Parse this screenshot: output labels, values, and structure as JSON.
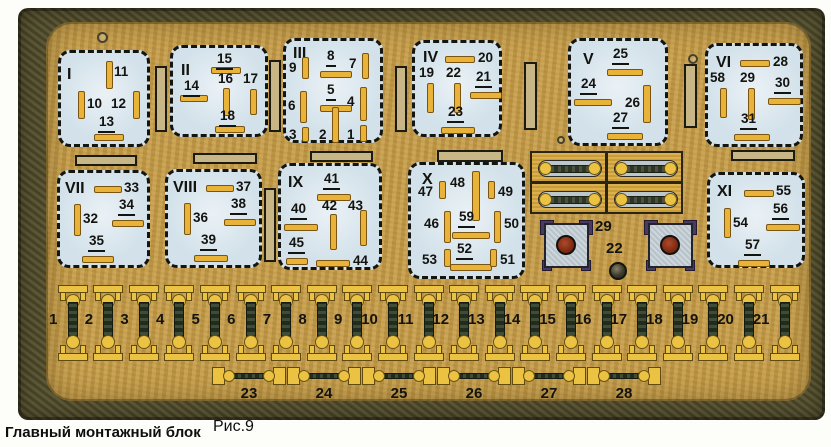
{
  "caption": {
    "title": "Главный монтажный блок",
    "figure": "Рис.9"
  },
  "colors": {
    "panel": "#c59c49",
    "frame": "#534e2c",
    "relay": "#d2e1ea",
    "pin": "#e9b238",
    "pin-border": "#7a5512",
    "slot": "#c8b687",
    "fuse": "#ecc243",
    "conn-body": "#c6d1d8",
    "conn-ear": "#4b3a60",
    "conn-circle": "#7e2b12",
    "ink": "#13130f"
  },
  "relays": [
    {
      "id": "I",
      "x": 58,
      "y": 50,
      "w": 92,
      "h": 97,
      "lx": 6,
      "ly": 14,
      "pins": [
        {
          "n": "11",
          "u": false,
          "px": 45,
          "py": 8,
          "pw": 7,
          "ph": 28,
          "lx": 53,
          "ly": 12
        },
        {
          "n": "10",
          "u": false,
          "px": 17,
          "py": 38,
          "pw": 7,
          "ph": 28,
          "lx": 26,
          "ly": 44
        },
        {
          "n": "12",
          "u": false,
          "px": 72,
          "py": 38,
          "pw": 7,
          "ph": 28,
          "lx": 50,
          "ly": 44
        },
        {
          "n": "13",
          "u": true,
          "px": 33,
          "py": 81,
          "pw": 30,
          "ph": 7,
          "lx": 37,
          "ly": 62
        }
      ]
    },
    {
      "id": "II",
      "x": 170,
      "y": 45,
      "w": 98,
      "h": 92,
      "lx": 8,
      "ly": 15,
      "pins": [
        {
          "n": "15",
          "u": true,
          "px": 38,
          "py": 19,
          "pw": 30,
          "ph": 7,
          "lx": 43,
          "ly": 4
        },
        {
          "n": "14",
          "u": true,
          "px": 7,
          "py": 47,
          "pw": 28,
          "ph": 7,
          "lx": 10,
          "ly": 31
        },
        {
          "n": "16",
          "u": false,
          "px": 50,
          "py": 40,
          "pw": 7,
          "ph": 28,
          "lx": 45,
          "ly": 24
        },
        {
          "n": "17",
          "u": false,
          "px": 77,
          "py": 41,
          "pw": 7,
          "ph": 26,
          "lx": 70,
          "ly": 24
        },
        {
          "n": "18",
          "u": true,
          "px": 42,
          "py": 78,
          "pw": 30,
          "ph": 7,
          "lx": 46,
          "ly": 61
        }
      ]
    },
    {
      "id": "III",
      "x": 283,
      "y": 38,
      "w": 100,
      "h": 105,
      "lx": 7,
      "ly": 5,
      "pins": [
        {
          "n": "9",
          "u": false,
          "px": 16,
          "py": 16,
          "pw": 7,
          "ph": 22,
          "lx": 3,
          "ly": 20
        },
        {
          "n": "8",
          "u": true,
          "px": 34,
          "py": 30,
          "pw": 32,
          "ph": 7,
          "lx": 40,
          "ly": 8
        },
        {
          "n": "7",
          "u": false,
          "px": 76,
          "py": 12,
          "pw": 7,
          "ph": 26,
          "lx": 63,
          "ly": 16
        },
        {
          "n": "6",
          "u": false,
          "px": 14,
          "py": 50,
          "pw": 7,
          "ph": 32,
          "lx": 2,
          "ly": 58
        },
        {
          "n": "5",
          "u": true,
          "px": 34,
          "py": 64,
          "pw": 32,
          "ph": 7,
          "lx": 40,
          "ly": 42
        },
        {
          "n": "4",
          "u": false,
          "px": 74,
          "py": 46,
          "pw": 7,
          "ph": 34,
          "lx": 61,
          "ly": 54
        },
        {
          "n": "3",
          "u": false,
          "px": 16,
          "py": 86,
          "pw": 7,
          "ph": 15,
          "lx": 3,
          "ly": 87
        },
        {
          "n": "2",
          "u": false,
          "px": 46,
          "py": 66,
          "pw": 7,
          "ph": 36,
          "lx": 33,
          "ly": 87
        },
        {
          "n": "1",
          "u": false,
          "px": 74,
          "py": 84,
          "pw": 7,
          "ph": 17,
          "lx": 61,
          "ly": 87
        }
      ]
    },
    {
      "id": "IV",
      "x": 412,
      "y": 40,
      "w": 90,
      "h": 97,
      "lx": 8,
      "ly": 7,
      "pins": [
        {
          "n": "20",
          "u": false,
          "px": 30,
          "py": 13,
          "pw": 30,
          "ph": 7,
          "lx": 63,
          "ly": 8
        },
        {
          "n": "19",
          "u": false,
          "px": 12,
          "py": 40,
          "pw": 7,
          "ph": 30,
          "lx": 4,
          "ly": 23
        },
        {
          "n": "22",
          "u": false,
          "px": 39,
          "py": 40,
          "pw": 7,
          "ph": 30,
          "lx": 31,
          "ly": 23
        },
        {
          "n": "21",
          "u": true,
          "px": 55,
          "py": 49,
          "pw": 32,
          "ph": 7,
          "lx": 60,
          "ly": 27
        },
        {
          "n": "23",
          "u": true,
          "px": 26,
          "py": 84,
          "pw": 34,
          "ph": 7,
          "lx": 32,
          "ly": 62
        }
      ]
    },
    {
      "id": "V",
      "x": 568,
      "y": 38,
      "w": 100,
      "h": 108,
      "lx": 12,
      "ly": 11,
      "pins": [
        {
          "n": "25",
          "u": true,
          "px": 36,
          "py": 28,
          "pw": 36,
          "ph": 7,
          "lx": 41,
          "ly": 6
        },
        {
          "n": "24",
          "u": true,
          "px": 3,
          "py": 58,
          "pw": 38,
          "ph": 7,
          "lx": 9,
          "ly": 36
        },
        {
          "n": "26",
          "u": false,
          "px": 72,
          "py": 44,
          "pw": 8,
          "ph": 38,
          "lx": 54,
          "ly": 55
        },
        {
          "n": "27",
          "u": true,
          "px": 36,
          "py": 92,
          "pw": 36,
          "ph": 7,
          "lx": 41,
          "ly": 70
        }
      ]
    },
    {
      "id": "VI",
      "x": 705,
      "y": 43,
      "w": 98,
      "h": 104,
      "lx": 8,
      "ly": 9,
      "pins": [
        {
          "n": "28",
          "u": false,
          "px": 32,
          "py": 14,
          "pw": 30,
          "ph": 7,
          "lx": 65,
          "ly": 9
        },
        {
          "n": "58",
          "u": false,
          "px": 12,
          "py": 42,
          "pw": 7,
          "ph": 30,
          "lx": 2,
          "ly": 25
        },
        {
          "n": "29",
          "u": false,
          "px": 40,
          "py": 42,
          "pw": 7,
          "ph": 32,
          "lx": 32,
          "ly": 25
        },
        {
          "n": "30",
          "u": true,
          "px": 60,
          "py": 52,
          "pw": 33,
          "ph": 7,
          "lx": 66,
          "ly": 30
        },
        {
          "n": "31",
          "u": true,
          "px": 26,
          "py": 88,
          "pw": 36,
          "ph": 7,
          "lx": 32,
          "ly": 66
        }
      ]
    },
    {
      "id": "VII",
      "x": 57,
      "y": 170,
      "w": 93,
      "h": 98,
      "lx": 5,
      "ly": 8,
      "pins": [
        {
          "n": "33",
          "u": false,
          "px": 34,
          "py": 13,
          "pw": 28,
          "ph": 7,
          "lx": 64,
          "ly": 8
        },
        {
          "n": "32",
          "u": false,
          "px": 14,
          "py": 31,
          "pw": 7,
          "ph": 32,
          "lx": 23,
          "ly": 39
        },
        {
          "n": "34",
          "u": true,
          "px": 52,
          "py": 47,
          "pw": 32,
          "ph": 7,
          "lx": 58,
          "ly": 25
        },
        {
          "n": "35",
          "u": true,
          "px": 22,
          "py": 83,
          "pw": 32,
          "ph": 7,
          "lx": 28,
          "ly": 61
        }
      ]
    },
    {
      "id": "VIII",
      "x": 165,
      "y": 169,
      "w": 97,
      "h": 99,
      "lx": 5,
      "ly": 8,
      "pins": [
        {
          "n": "37",
          "u": false,
          "px": 38,
          "py": 13,
          "pw": 28,
          "ph": 7,
          "lx": 68,
          "ly": 8
        },
        {
          "n": "36",
          "u": false,
          "px": 16,
          "py": 31,
          "pw": 7,
          "ph": 32,
          "lx": 25,
          "ly": 39
        },
        {
          "n": "38",
          "u": true,
          "px": 56,
          "py": 47,
          "pw": 32,
          "ph": 7,
          "lx": 62,
          "ly": 25
        },
        {
          "n": "39",
          "u": true,
          "px": 26,
          "py": 83,
          "pw": 34,
          "ph": 7,
          "lx": 32,
          "ly": 61
        }
      ]
    },
    {
      "id": "IX",
      "x": 278,
      "y": 163,
      "w": 104,
      "h": 107,
      "lx": 7,
      "ly": 9,
      "pins": [
        {
          "n": "41",
          "u": true,
          "px": 36,
          "py": 28,
          "pw": 34,
          "ph": 7,
          "lx": 42,
          "ly": 6
        },
        {
          "n": "40",
          "u": true,
          "px": 3,
          "py": 58,
          "pw": 34,
          "ph": 7,
          "lx": 9,
          "ly": 36
        },
        {
          "n": "42",
          "u": false,
          "px": 49,
          "py": 48,
          "pw": 7,
          "ph": 36,
          "lx": 41,
          "ly": 33
        },
        {
          "n": "43",
          "u": false,
          "px": 79,
          "py": 44,
          "pw": 7,
          "ph": 36,
          "lx": 67,
          "ly": 33
        },
        {
          "n": "45",
          "u": true,
          "px": 5,
          "py": 92,
          "pw": 22,
          "ph": 7,
          "lx": 7,
          "ly": 70
        },
        {
          "n": "44",
          "u": false,
          "px": 35,
          "py": 94,
          "pw": 34,
          "ph": 7,
          "lx": 72,
          "ly": 88
        }
      ]
    },
    {
      "id": "X",
      "x": 408,
      "y": 162,
      "w": 117,
      "h": 117,
      "lx": 11,
      "ly": 7,
      "pins": [
        {
          "n": "47",
          "u": false,
          "px": 28,
          "py": 16,
          "pw": 7,
          "ph": 18,
          "lx": 7,
          "ly": 20
        },
        {
          "n": "48",
          "u": false,
          "px": 61,
          "py": 6,
          "pw": 8,
          "ph": 50,
          "lx": 39,
          "ly": 11
        },
        {
          "n": "49",
          "u": false,
          "px": 77,
          "py": 16,
          "pw": 7,
          "ph": 18,
          "lx": 87,
          "ly": 20
        },
        {
          "n": "46",
          "u": false,
          "px": 33,
          "py": 46,
          "pw": 7,
          "ph": 32,
          "lx": 13,
          "ly": 52
        },
        {
          "n": "59",
          "u": true,
          "px": 41,
          "py": 67,
          "pw": 38,
          "ph": 7,
          "lx": 47,
          "ly": 45
        },
        {
          "n": "50",
          "u": false,
          "px": 83,
          "py": 46,
          "pw": 7,
          "ph": 32,
          "lx": 93,
          "ly": 52
        },
        {
          "n": "53",
          "u": false,
          "px": 33,
          "py": 84,
          "pw": 7,
          "ph": 18,
          "lx": 11,
          "ly": 88
        },
        {
          "n": "52",
          "u": true,
          "px": 39,
          "py": 99,
          "pw": 42,
          "ph": 7,
          "lx": 45,
          "ly": 77
        },
        {
          "n": "51",
          "u": false,
          "px": 79,
          "py": 84,
          "pw": 7,
          "ph": 18,
          "lx": 89,
          "ly": 88
        }
      ]
    },
    {
      "id": "XI",
      "x": 707,
      "y": 172,
      "w": 98,
      "h": 96,
      "lx": 7,
      "ly": 9,
      "pins": [
        {
          "n": "55",
          "u": false,
          "px": 34,
          "py": 15,
          "pw": 30,
          "ph": 7,
          "lx": 66,
          "ly": 9
        },
        {
          "n": "54",
          "u": false,
          "px": 14,
          "py": 33,
          "pw": 7,
          "ph": 30,
          "lx": 23,
          "ly": 41
        },
        {
          "n": "56",
          "u": true,
          "px": 56,
          "py": 49,
          "pw": 34,
          "ph": 7,
          "lx": 62,
          "ly": 27
        },
        {
          "n": "57",
          "u": true,
          "px": 28,
          "py": 85,
          "pw": 32,
          "ph": 7,
          "lx": 34,
          "ly": 63
        }
      ]
    }
  ],
  "vertical_slots": [
    {
      "x": 155,
      "y": 66,
      "w": 12,
      "h": 66
    },
    {
      "x": 269,
      "y": 60,
      "w": 12,
      "h": 72
    },
    {
      "x": 395,
      "y": 66,
      "w": 12,
      "h": 66
    },
    {
      "x": 524,
      "y": 62,
      "w": 13,
      "h": 68
    },
    {
      "x": 684,
      "y": 64,
      "w": 13,
      "h": 64
    },
    {
      "x": 264,
      "y": 188,
      "w": 12,
      "h": 74
    }
  ],
  "horizontal_slots": [
    {
      "x": 75,
      "y": 155,
      "w": 62,
      "h": 11
    },
    {
      "x": 193,
      "y": 153,
      "w": 64,
      "h": 11
    },
    {
      "x": 310,
      "y": 151,
      "w": 63,
      "h": 11
    },
    {
      "x": 437,
      "y": 150,
      "w": 66,
      "h": 12
    },
    {
      "x": 731,
      "y": 150,
      "w": 64,
      "h": 11
    }
  ],
  "screws": [
    {
      "x": 97,
      "y": 32,
      "d": 11,
      "type": "outline"
    },
    {
      "x": 688,
      "y": 54,
      "d": 10,
      "type": "outline"
    },
    {
      "x": 557,
      "y": 136,
      "d": 8,
      "type": "outline"
    },
    {
      "x": 609,
      "y": 262,
      "d": 18,
      "type": "filled"
    }
  ],
  "main_fuse_block": {
    "x": 530,
    "y": 151,
    "rows": 2,
    "cols": 2,
    "cell_w": 77,
    "cell_h": 32
  },
  "connectors": {
    "items": [
      {
        "x": 540,
        "y": 220
      },
      {
        "x": 644,
        "y": 220
      }
    ],
    "labels": [
      {
        "text": "29",
        "x": 595,
        "y": 219
      },
      {
        "text": "22",
        "x": 606,
        "y": 241
      }
    ]
  },
  "fuse_row": {
    "numbers": [
      "1",
      "2",
      "3",
      "4",
      "5",
      "6",
      "7",
      "8",
      "9",
      "10",
      "11",
      "12",
      "13",
      "14",
      "15",
      "16",
      "17",
      "18",
      "19",
      "20",
      "21"
    ],
    "start_cx": 72.5,
    "spacing": 35.6,
    "top": 285,
    "label_y": 312
  },
  "link_row": {
    "numbers": [
      "23",
      "24",
      "25",
      "26",
      "27",
      "28"
    ],
    "start_cx": 249,
    "spacing": 75,
    "top": 367,
    "label_y": 386
  }
}
